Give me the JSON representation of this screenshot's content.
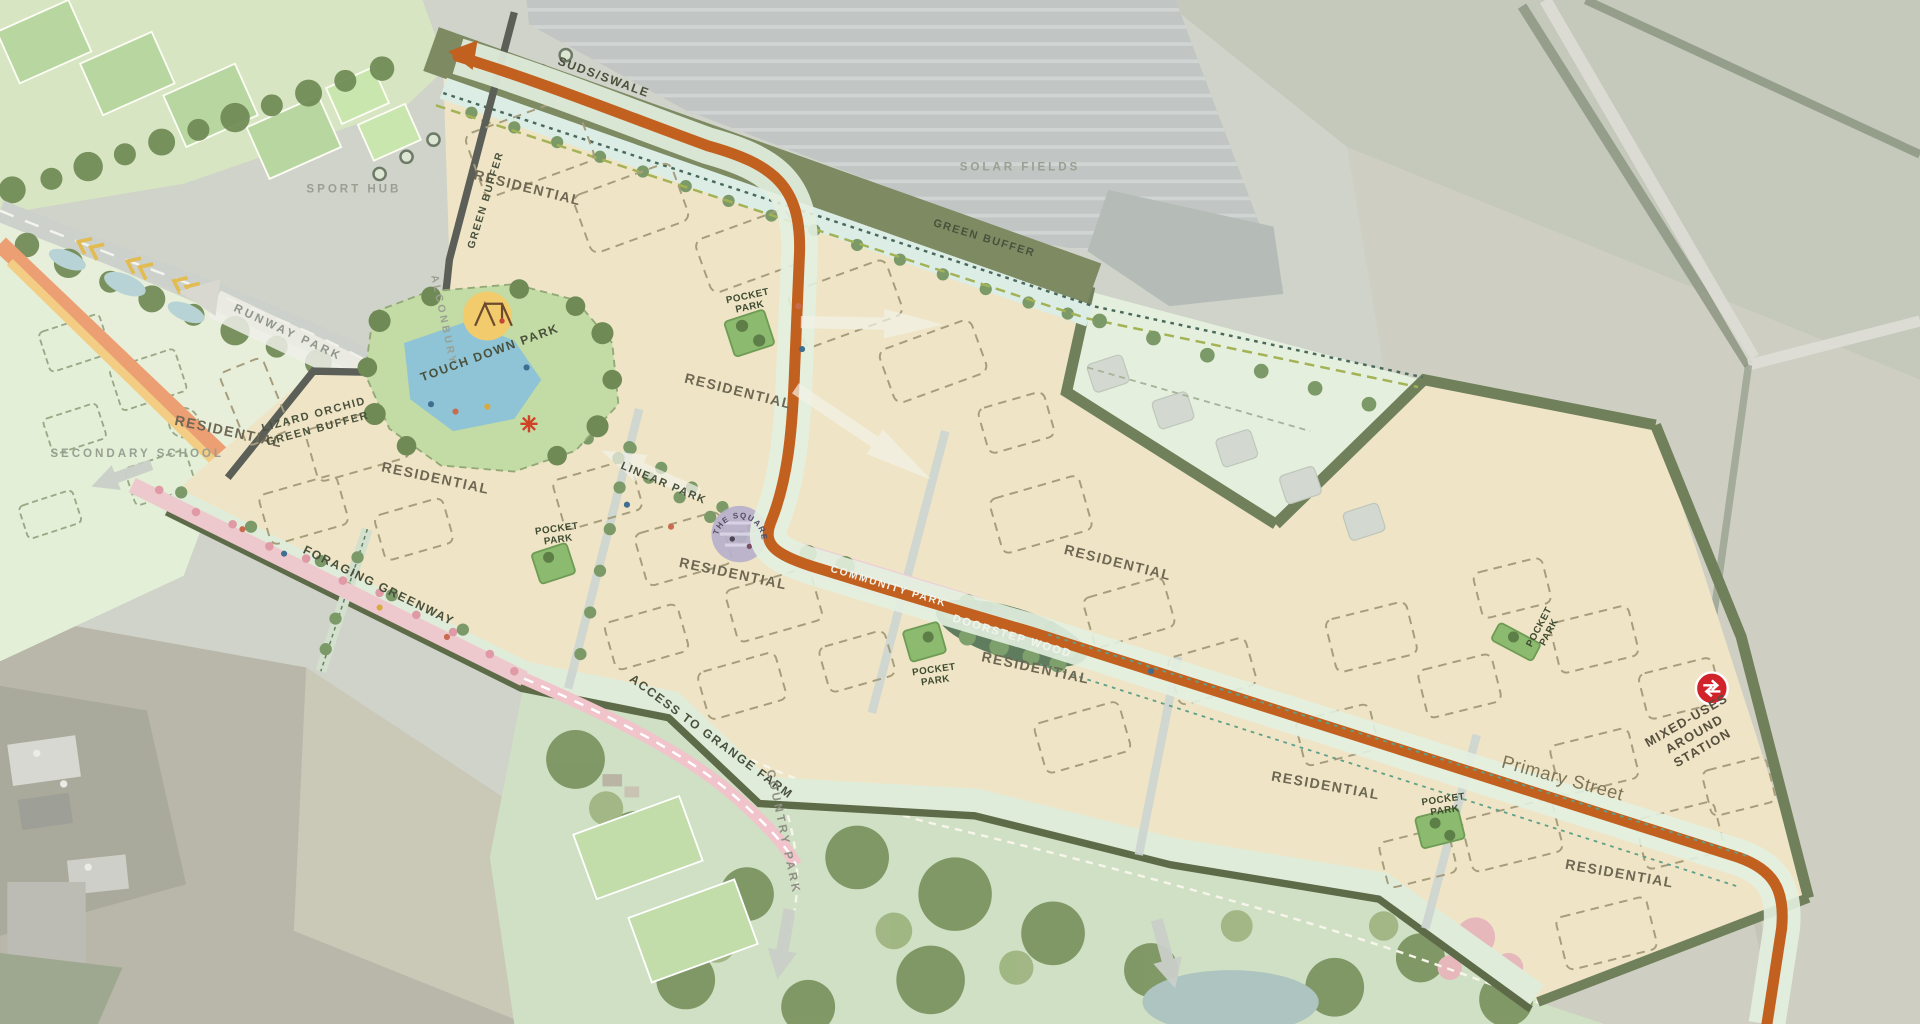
{
  "map": {
    "description": "Illustrative development framework masterplan overlaid on aerial photography",
    "labels": {
      "residential": "RESIDENTIAL",
      "pocket_park": {
        "line1": "POCKET",
        "line2": "PARK"
      },
      "suds_swale": "SUDS/SWALE",
      "green_buffer_edge": "GREEN BUFFER",
      "green_buffer_north": "GREEN BUFFER",
      "solar_fields": "SOLAR FIELDS",
      "sport_hub": "SPORT HUB",
      "runway_park": "RUNWAY PARK",
      "secondary_school": "SECONDARY SCHOOL",
      "alconbury": "ALCONBURY",
      "touch_down_park": "TOUCH DOWN PARK",
      "lizard_orchid_buffer": {
        "line1": "LIZARD ORCHID",
        "line2": "GREEN BUFFER"
      },
      "linear_park": "LINEAR PARK",
      "the_square": "THE SQUARE",
      "community_park": "COMMUNITY PARK",
      "doorstep_wood": "DOORSTEP WOOD",
      "foraging_greenway": "FORAGING GREENWAY",
      "access_to_grange_farm": "ACCESS TO GRANGE FARM",
      "country_park": "COUNTRY PARK",
      "primary_street": "Primary Street",
      "mixed_uses_station": {
        "line1": "MIXED-USES",
        "line2": "AROUND",
        "line3": "STATION"
      }
    },
    "icons": {
      "rail_station": "national-rail-double-arrow",
      "play_area": "swing-set",
      "direction_arrows": "block-arrow",
      "feature_marker": "red-asterisk"
    },
    "colors": {
      "primary_street_orange": "#c2601f",
      "development_cream": "#efe5c6",
      "green_buffer_olive": "#7d8a62",
      "pocket_park_green": "#8cbb70",
      "greenway_pink": "#edc9ce",
      "square_purple": "#b7b0ca",
      "station_red": "#d2232a",
      "water_blue": "#8fc3d6"
    }
  }
}
